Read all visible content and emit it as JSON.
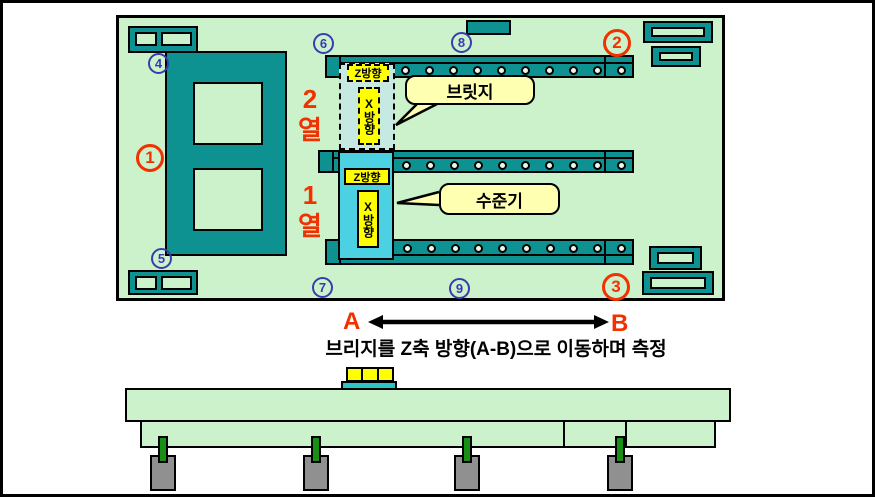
{
  "colors": {
    "panel_green": "#ccf2cb",
    "teal": "#0e9191",
    "bridge_cyan": "#4bd1e1",
    "ghost_cyan": "#c6eae2",
    "label_yellow": "#ffff00",
    "callout_yellow": "#ffffb2",
    "accent_red": "#f23000",
    "accent_blue": "#3a3ab2",
    "leg_green": "#189018",
    "foot_gray": "#909090"
  },
  "plan": {
    "markers": {
      "red": [
        "1",
        "2",
        "3"
      ],
      "blue": [
        "4",
        "5",
        "6",
        "7",
        "8",
        "9"
      ]
    },
    "rows": {
      "row2": "2\n열",
      "row1": "1\n열"
    },
    "bridge_row2": {
      "z_label": "Z방향",
      "x_label": "X방향"
    },
    "bridge_row1": {
      "z_label": "Z방향",
      "x_label": "X방향"
    },
    "callouts": {
      "bridge": "브릿지",
      "level": "수준기"
    }
  },
  "motion": {
    "point_a": "A",
    "point_b": "B",
    "caption": "브리지를 Z축 방향(A-B)으로 이동하며 측정"
  }
}
